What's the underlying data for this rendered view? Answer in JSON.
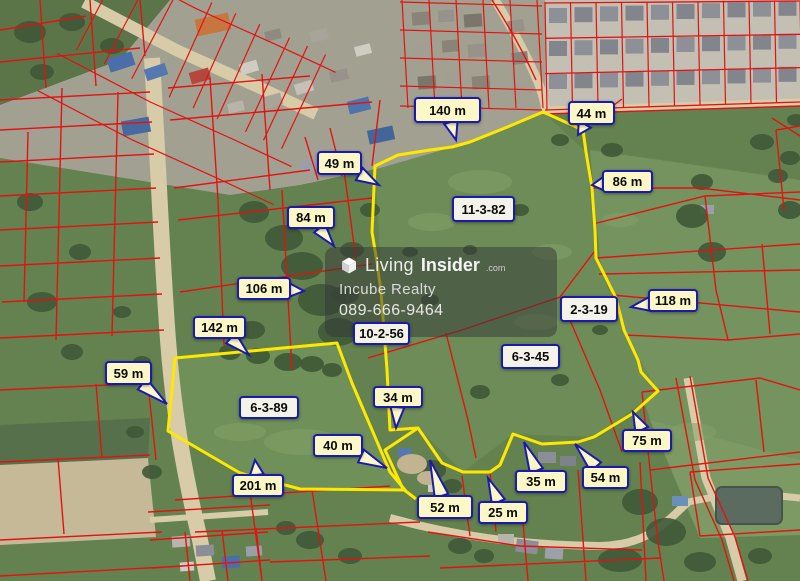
{
  "watermark": {
    "brand_light": "Living",
    "brand_bold": "Insider",
    "brand_suffix": ".com",
    "company": "Incube Realty",
    "phone": "089-666-9464"
  },
  "colors": {
    "parcel_line": "#e31212",
    "highlight": "#ffe800",
    "label_border": "#1a1aae",
    "measure_bg": "#fbf7c6",
    "area_bg": "#f3f3ea"
  },
  "labels": {
    "measurements": [
      {
        "text": "49 m",
        "x": 317,
        "y": 151,
        "w": 45,
        "h": 24,
        "tip": [
          379,
          185
        ]
      },
      {
        "text": "140 m",
        "x": 414,
        "y": 97,
        "w": 67,
        "h": 26,
        "tip": [
          456,
          140
        ]
      },
      {
        "text": "44 m",
        "x": 568,
        "y": 101,
        "w": 47,
        "h": 24,
        "tip": [
          578,
          135
        ]
      },
      {
        "text": "86 m",
        "x": 602,
        "y": 170,
        "w": 51,
        "h": 23,
        "tip": [
          592,
          185
        ]
      },
      {
        "text": "84 m",
        "x": 287,
        "y": 206,
        "w": 48,
        "h": 23,
        "tip": [
          334,
          246
        ]
      },
      {
        "text": "106 m",
        "x": 237,
        "y": 277,
        "w": 54,
        "h": 23,
        "tip": [
          304,
          291
        ]
      },
      {
        "text": "118 m",
        "x": 648,
        "y": 289,
        "w": 50,
        "h": 23,
        "tip": [
          631,
          307
        ]
      },
      {
        "text": "142 m",
        "x": 193,
        "y": 316,
        "w": 53,
        "h": 23,
        "tip": [
          249,
          355
        ]
      },
      {
        "text": "59 m",
        "x": 105,
        "y": 361,
        "w": 47,
        "h": 24,
        "tip": [
          167,
          404
        ]
      },
      {
        "text": "34 m",
        "x": 373,
        "y": 386,
        "w": 50,
        "h": 22,
        "tip": [
          396,
          428
        ]
      },
      {
        "text": "40 m",
        "x": 313,
        "y": 434,
        "w": 50,
        "h": 23,
        "tip": [
          387,
          468
        ]
      },
      {
        "text": "75 m",
        "x": 622,
        "y": 429,
        "w": 50,
        "h": 23,
        "tip": [
          633,
          412
        ]
      },
      {
        "text": "35 m",
        "x": 515,
        "y": 470,
        "w": 52,
        "h": 23,
        "tip": [
          524,
          442
        ]
      },
      {
        "text": "54 m",
        "x": 582,
        "y": 466,
        "w": 47,
        "h": 23,
        "tip": [
          575,
          444
        ]
      },
      {
        "text": "201 m",
        "x": 232,
        "y": 474,
        "w": 52,
        "h": 23,
        "tip": [
          255,
          460
        ]
      },
      {
        "text": "52 m",
        "x": 417,
        "y": 495,
        "w": 56,
        "h": 24,
        "tip": [
          430,
          460
        ]
      },
      {
        "text": "25 m",
        "x": 478,
        "y": 501,
        "w": 50,
        "h": 23,
        "tip": [
          488,
          478
        ]
      }
    ],
    "areas": [
      {
        "text": "11-3-82",
        "x": 452,
        "y": 196,
        "w": 63,
        "h": 26
      },
      {
        "text": "2-3-19",
        "x": 560,
        "y": 296,
        "w": 58,
        "h": 26
      },
      {
        "text": "6-3-45",
        "x": 501,
        "y": 344,
        "w": 59,
        "h": 25
      },
      {
        "text": "10-2-56",
        "x": 353,
        "y": 322,
        "w": 57,
        "h": 23
      },
      {
        "text": "6-3-89",
        "x": 239,
        "y": 396,
        "w": 60,
        "h": 23
      }
    ]
  }
}
